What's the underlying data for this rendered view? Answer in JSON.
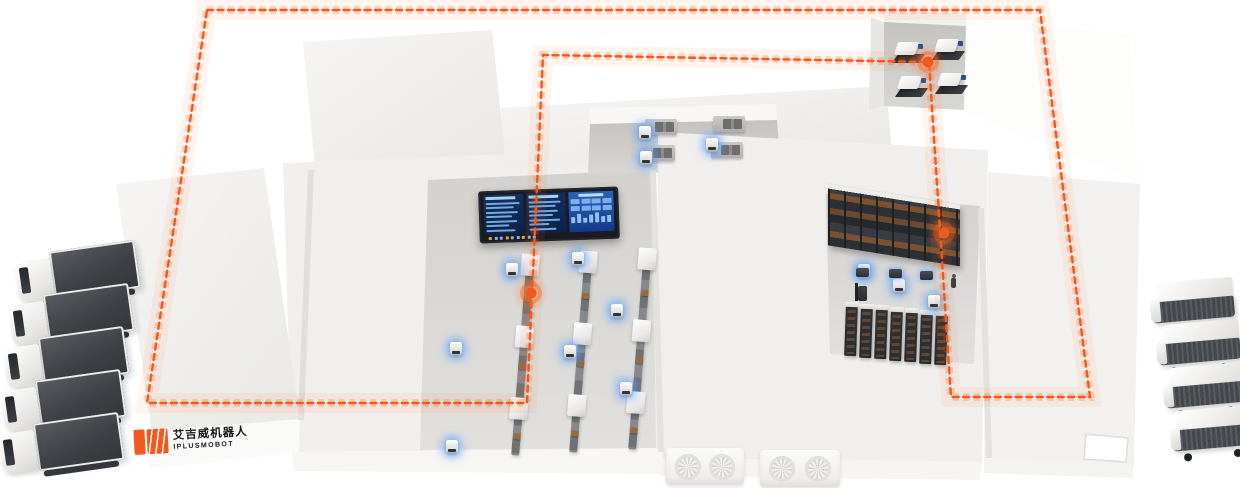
{
  "logo": {
    "brand_cn": "艾吉威机器人",
    "brand_en": "IPLUSMOBOT"
  },
  "palette": {
    "accent": "#F2591D",
    "accent_glow": "#FF7A33",
    "agv_glow_blue": "#569EFF",
    "building_top": "#F2F1EF",
    "building_front": "#FAFAF9",
    "floor": "#D6D5D2",
    "machine_dark": "#2F3237",
    "container_dark": "#43464A",
    "cargo_brown": "#8A5A33",
    "screen_frame": "#191B20",
    "screen_panel": "#123061",
    "screen_rows": "#7FB8EC",
    "screen_panel_right": "#2A62B8",
    "screen_tick_orange": "#F2A13C"
  },
  "route": {
    "points": "207,10 1040,10 1090,397 951,397 929,62 543,55 527,403 147,403",
    "closed": true,
    "dash": "6 4.5",
    "waypoints": [
      {
        "x": 928,
        "y": 62
      },
      {
        "x": 944,
        "y": 233
      },
      {
        "x": 531,
        "y": 293
      }
    ]
  },
  "fleet": {
    "trucks": [
      {
        "x": 16,
        "y": 246
      },
      {
        "x": 10,
        "y": 289
      },
      {
        "x": 5,
        "y": 332
      },
      {
        "x": 2,
        "y": 375
      },
      {
        "x": 0,
        "y": 418
      }
    ],
    "vans": [
      {
        "x": 1150,
        "y": 280
      },
      {
        "x": 1156,
        "y": 322
      },
      {
        "x": 1163,
        "y": 365
      },
      {
        "x": 1170,
        "y": 408
      }
    ]
  },
  "agvs": {
    "light": [
      [
        506,
        263
      ],
      [
        572,
        252
      ],
      [
        611,
        304
      ],
      [
        564,
        345
      ],
      [
        450,
        342
      ],
      [
        620,
        382
      ],
      [
        446,
        440
      ],
      [
        639,
        126
      ],
      [
        706,
        138
      ],
      [
        640,
        151
      ],
      [
        858,
        264
      ],
      [
        893,
        279
      ],
      [
        928,
        295
      ]
    ],
    "dark": [
      [
        856,
        268
      ],
      [
        889,
        269
      ],
      [
        920,
        271
      ]
    ]
  },
  "conveyors": {
    "lines": [
      {
        "x": 531,
        "y": 254
      },
      {
        "x": 589,
        "y": 251
      },
      {
        "x": 648,
        "y": 248
      }
    ],
    "machine_tops": [
      0,
      72,
      144
    ],
    "cargo_tops": [
      42,
      110,
      180
    ]
  },
  "racks": {
    "rows": {
      "count": 7,
      "x": 845,
      "y": 306,
      "step_x": 15,
      "step_y": 1.5
    }
  },
  "dock_machines": [
    [
      893,
      42
    ],
    [
      933,
      39
    ],
    [
      896,
      76
    ],
    [
      936,
      73
    ]
  ],
  "workstations": [
    [
      645,
      119
    ],
    [
      713,
      116
    ],
    [
      643,
      145
    ],
    [
      711,
      142
    ]
  ],
  "hvac": {
    "blocks": [
      {
        "x": 666,
        "y": 448,
        "w": 78,
        "h": 37
      },
      {
        "x": 760,
        "y": 450,
        "w": 80,
        "h": 37
      }
    ],
    "fans_per_block": 2
  },
  "figures": {
    "person": [
      951,
      278
    ],
    "forklift": [
      858,
      286
    ]
  },
  "dashboard": {
    "left_rows": [
      95,
      80,
      90,
      72,
      86,
      64,
      82
    ],
    "mid_rows": [
      90,
      76,
      84,
      68,
      88,
      58,
      78
    ],
    "right_blocks": 8,
    "right_bars": [
      60,
      85,
      45,
      75,
      95,
      55,
      70
    ],
    "footer_ticks": 9
  }
}
